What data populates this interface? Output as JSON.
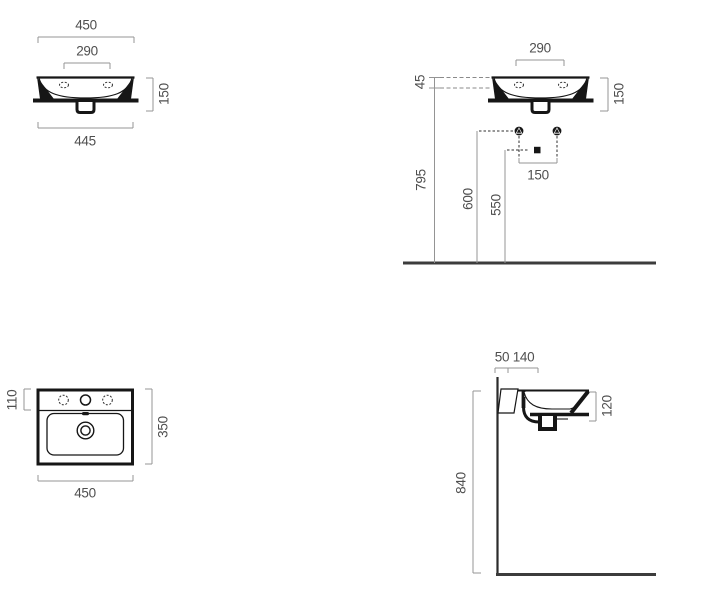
{
  "drawing": {
    "type": "washbasin-technical-drawing",
    "colors": {
      "object_line": "#161616",
      "dimension_line": "#949494",
      "dimension_text": "#4f4f4f",
      "floor_line": "#3c3c3c",
      "background": "#ffffff"
    },
    "views": {
      "front": {
        "dims": {
          "overall_width": "450",
          "tap_hole_spacing": "290",
          "height": "150",
          "bottom_width": "445"
        }
      },
      "installation": {
        "dims": {
          "tap_hole_spacing": "290",
          "rim_offset": "45",
          "height": "150",
          "rim_level_height": "795",
          "fixing_height": "600",
          "trap_height": "550",
          "fixing_spacing": "150"
        }
      },
      "plan": {
        "dims": {
          "deck_depth": "110",
          "overall_depth": "350",
          "overall_width": "450"
        }
      },
      "side": {
        "dims": {
          "wall_offset": "50",
          "drain_offset": "140",
          "basin_height": "120",
          "rim_height": "840"
        }
      }
    }
  }
}
